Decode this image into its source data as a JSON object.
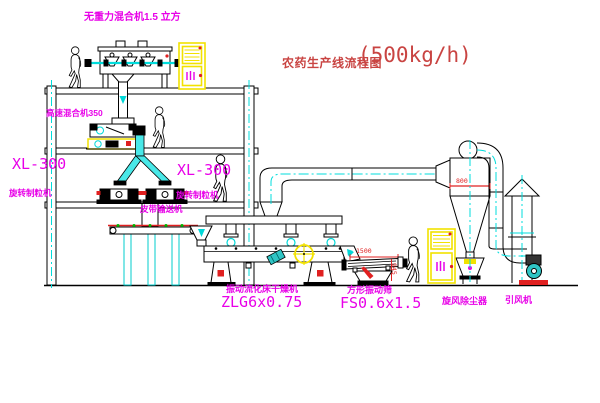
{
  "title": {
    "text": "农药生产线流程图",
    "capacity": "(500kg/h)"
  },
  "labels": {
    "gravity_free_mixer": "无重力混合机1.5 立方",
    "high_speed_mixer": "高速混合机350",
    "granulator_left_model": "XL-300",
    "granulator_left_name": "旋转制粒机",
    "granulator_mid_model": "XL-300",
    "granulator_mid_name": "旋转制粒机",
    "belt_conveyor": "皮带输送机",
    "fluid_bed_dryer_name": "振动流化床干燥机",
    "fluid_bed_dryer_model": "ZLG6x0.75",
    "square_sieve_name": "方形振动筛",
    "square_sieve_model": "FS0.6x1.5",
    "cyclone_dust_collector": "旋风除尘器",
    "induced_draft_fan": "引风机"
  },
  "dimensions": {
    "sieve_length": "1500",
    "sieve_height": "945",
    "cyclone_inlet": "800"
  },
  "colors": {
    "label_magenta": "#e800e8",
    "title_red": "#c94442",
    "centerline_cyan": "#00dcdc",
    "cabinet_yellow": "#f2e200",
    "dimension_red": "#e02020"
  }
}
